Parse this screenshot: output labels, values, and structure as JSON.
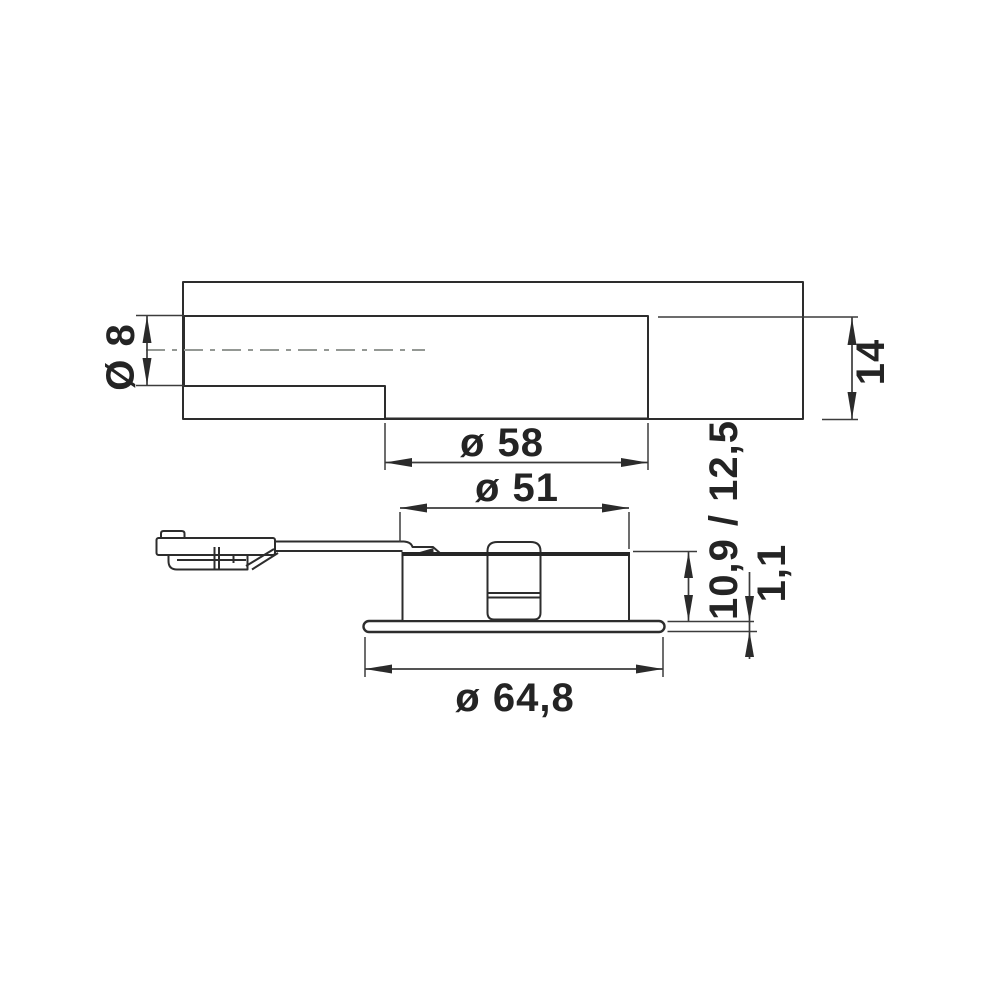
{
  "colors": {
    "panel_fill": "#d6d8d6",
    "line": "#2d2d2d",
    "centerline": "#949894"
  },
  "labels": {
    "cable_hole_diameter": "Ø 8",
    "panel_thickness": "14",
    "bore_diameter": "ø 58",
    "body_diameter": "ø 51",
    "recess_depth": "10,9 / 12,5",
    "flange_thickness": "1,1",
    "flange_diameter": "ø 64,8"
  }
}
